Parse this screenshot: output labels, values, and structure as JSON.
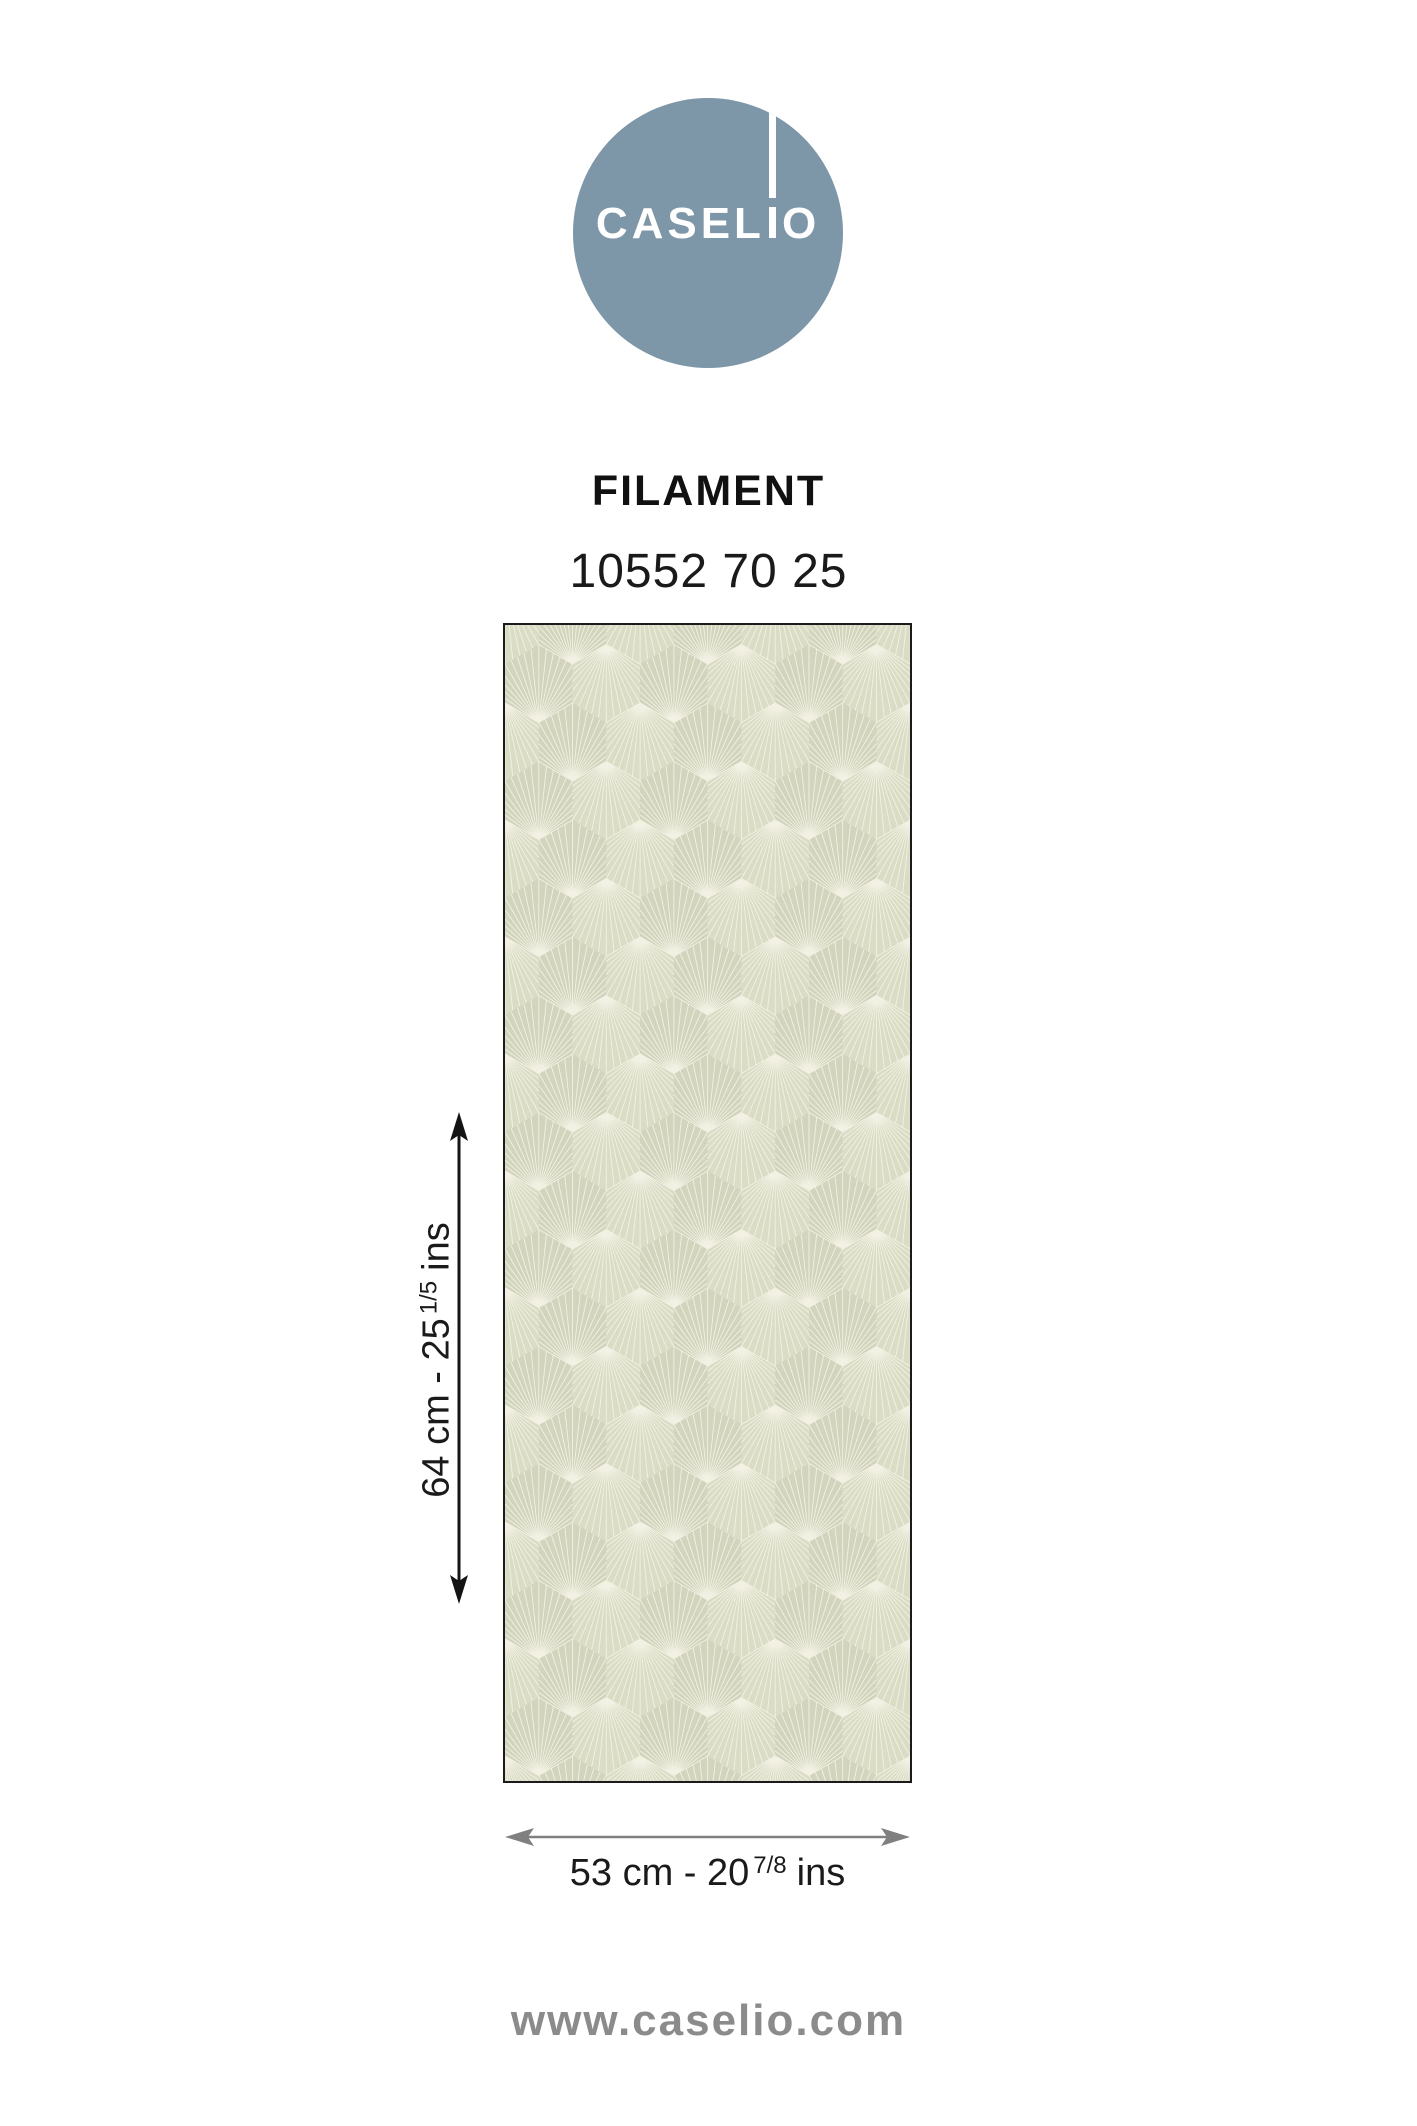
{
  "logo": {
    "brand_prefix": "CASEL",
    "brand_suffix": "O",
    "circle_color": "#7D96A8",
    "text_color": "#ffffff"
  },
  "product": {
    "name": "FILAMENT",
    "reference": "10552 70 25"
  },
  "swatch": {
    "pattern": "fan-filament",
    "background_color": "#d6d8c1",
    "face_light": "#dadcc5",
    "face_dark": "#d2d4bd",
    "ray_color": "#f4f3e6",
    "border_color": "#1b1b1b"
  },
  "dimensions": {
    "height": {
      "main": "64 cm - 25",
      "fraction": "1/5",
      "unit": "ins",
      "arrow_color": "#141414"
    },
    "width": {
      "main": "53 cm - 20",
      "fraction": "7/8",
      "unit": "ins",
      "arrow_color": "#808080"
    }
  },
  "footer": {
    "website": "www.caselio.com",
    "color": "#8b8b8b"
  }
}
